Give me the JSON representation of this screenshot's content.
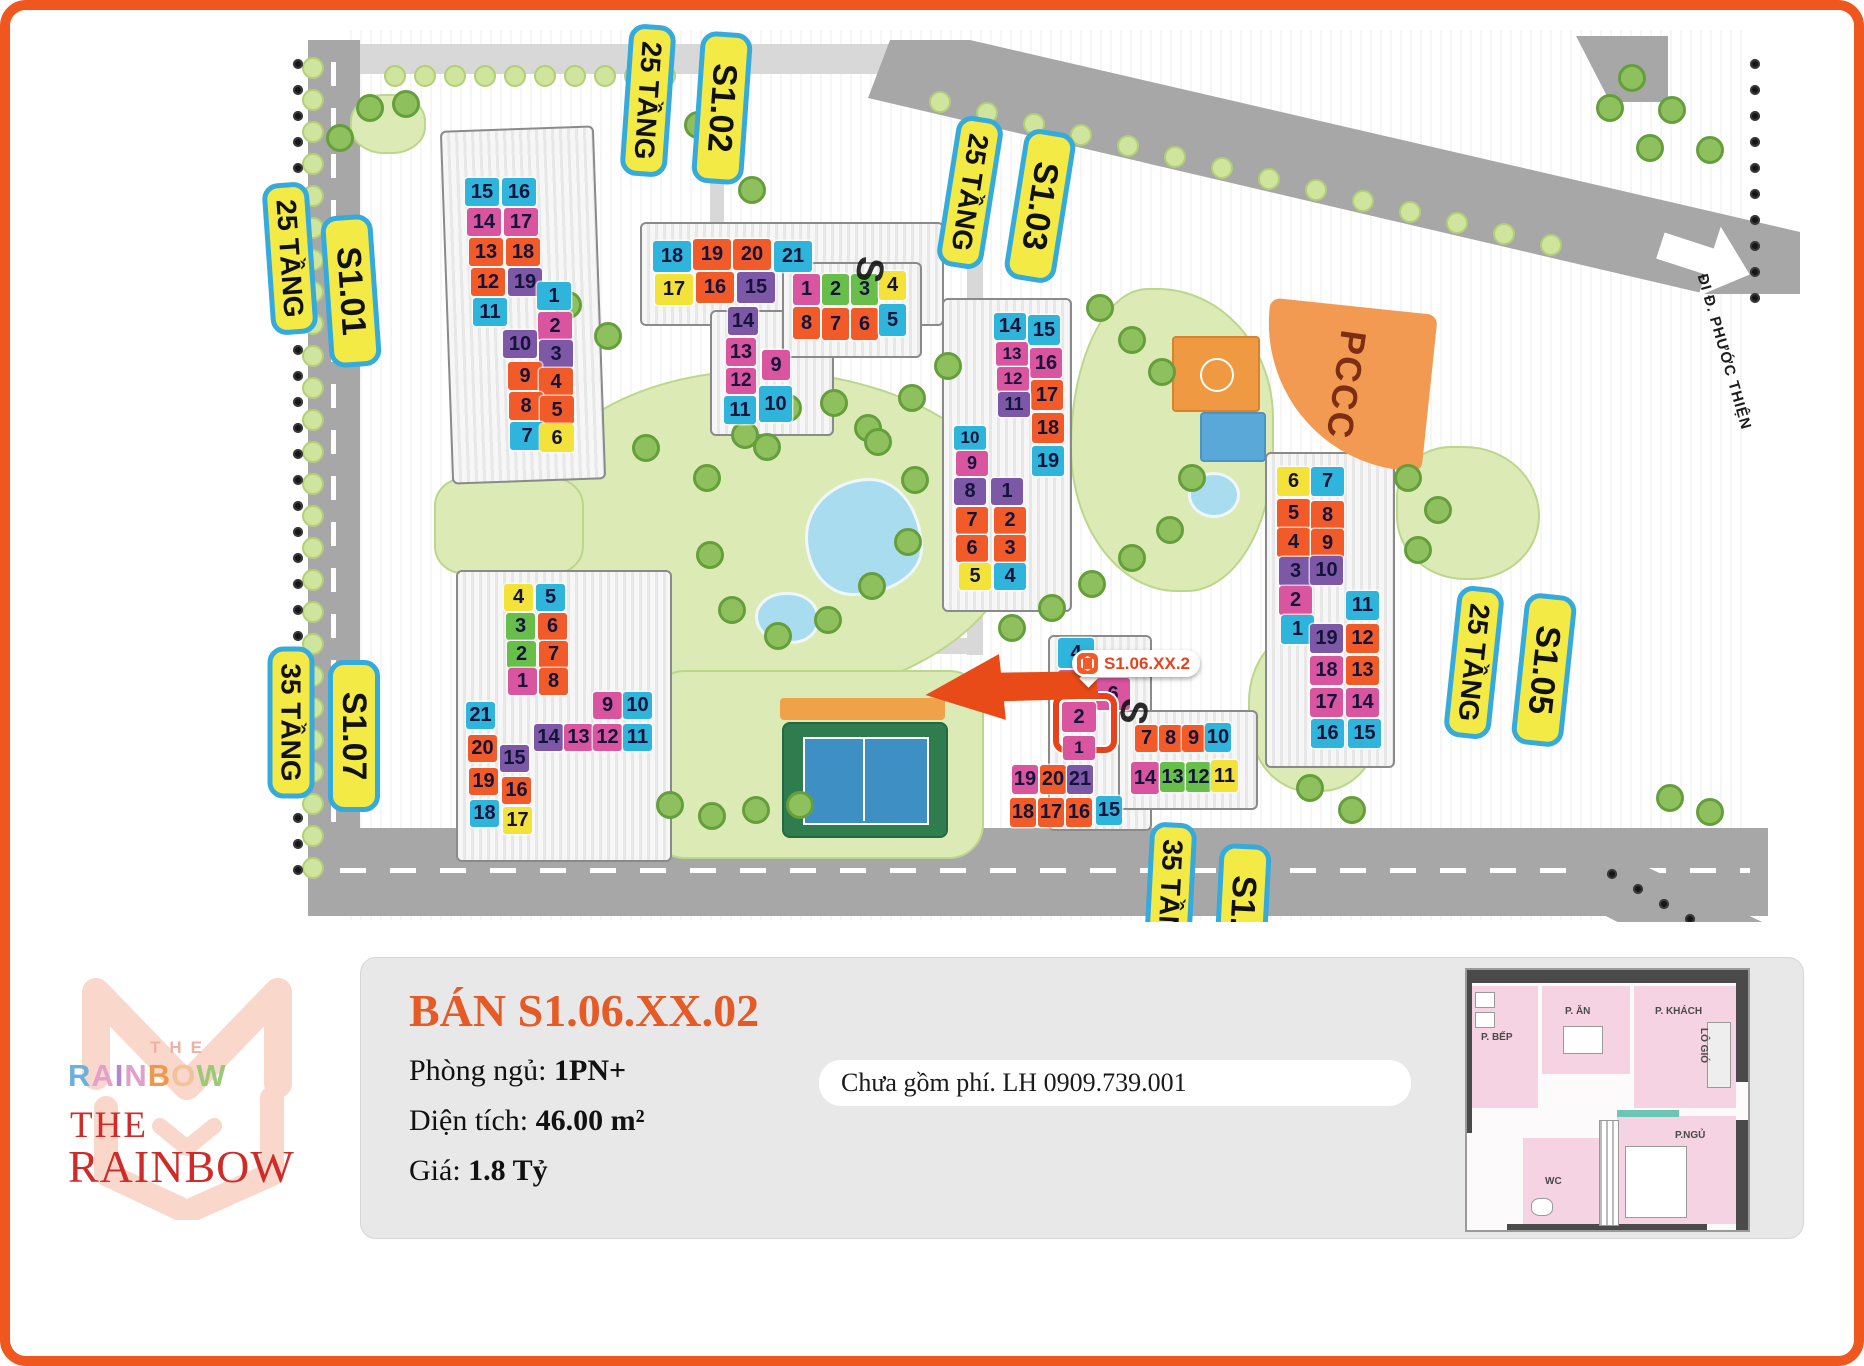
{
  "map": {
    "street_name": "ĐI Đ. PHƯỚC THIỆN",
    "pccc_label": "PCCC",
    "marker_text": "S1.06.XX.2",
    "palette": {
      "cyan": "#2fb4dc",
      "magenta": "#d9559f",
      "orange": "#f15a29",
      "purple": "#7d58a6",
      "yellow": "#f3e239",
      "green": "#67bf4a",
      "highlight": "#e8421c",
      "pill_bg": "#f4ea45",
      "pill_border": "#35aadc"
    },
    "pills": [
      {
        "text": "25 TẦNG",
        "x": 256,
        "y": 172,
        "rot": 86,
        "kind": "floors"
      },
      {
        "text": "S1.01",
        "x": 315,
        "y": 205,
        "rot": 86,
        "kind": "tower"
      },
      {
        "text": "25 TẦNG",
        "x": 614,
        "y": 14,
        "rot": 94,
        "kind": "floors"
      },
      {
        "text": "S1.02",
        "x": 686,
        "y": 22,
        "rot": 94,
        "kind": "tower"
      },
      {
        "text": "25 TẦNG",
        "x": 936,
        "y": 106,
        "rot": 99,
        "kind": "floors"
      },
      {
        "text": "S1.03",
        "x": 1004,
        "y": 120,
        "rot": 99,
        "kind": "tower"
      },
      {
        "text": "25 TẦNG",
        "x": 1440,
        "y": 576,
        "rot": 96,
        "kind": "floors"
      },
      {
        "text": "S1.05",
        "x": 1508,
        "y": 584,
        "rot": 96,
        "kind": "tower"
      },
      {
        "text": "35 TẦNG",
        "x": 257,
        "y": 636,
        "rot": 90,
        "kind": "floors"
      },
      {
        "text": "S1.07",
        "x": 318,
        "y": 650,
        "rot": 90,
        "kind": "tower"
      },
      {
        "text": "35 TẦNG",
        "x": 1136,
        "y": 812,
        "rot": 93,
        "kind": "floors"
      },
      {
        "text": "S1.06",
        "x": 1206,
        "y": 834,
        "rot": 93,
        "kind": "tower"
      }
    ],
    "decor_letters": [
      {
        "t": "S",
        "x": 846,
        "y": 238,
        "rot": 100
      },
      {
        "t": "S",
        "x": 1110,
        "y": 680,
        "rot": 100
      }
    ],
    "buildings": [
      {
        "id": "s1-01",
        "tw": 34,
        "th": 28,
        "tiles": [
          {
            "n": "15",
            "c": "cy",
            "x": 455,
            "y": 168
          },
          {
            "n": "16",
            "c": "cy",
            "x": 492,
            "y": 168
          },
          {
            "n": "14",
            "c": "mg",
            "x": 457,
            "y": 198
          },
          {
            "n": "17",
            "c": "mg",
            "x": 494,
            "y": 198
          },
          {
            "n": "13",
            "c": "or",
            "x": 459,
            "y": 228
          },
          {
            "n": "18",
            "c": "or",
            "x": 496,
            "y": 228
          },
          {
            "n": "12",
            "c": "or",
            "x": 461,
            "y": 258
          },
          {
            "n": "19",
            "c": "pu",
            "x": 498,
            "y": 258
          },
          {
            "n": "11",
            "c": "cy",
            "x": 463,
            "y": 288
          },
          {
            "n": "1",
            "c": "cy",
            "x": 527,
            "y": 272
          },
          {
            "n": "2",
            "c": "mg",
            "x": 528,
            "y": 302
          },
          {
            "n": "10",
            "c": "pu",
            "x": 493,
            "y": 320
          },
          {
            "n": "3",
            "c": "pu",
            "x": 529,
            "y": 330
          },
          {
            "n": "9",
            "c": "or",
            "x": 498,
            "y": 352
          },
          {
            "n": "4",
            "c": "or",
            "x": 529,
            "y": 358
          },
          {
            "n": "8",
            "c": "or",
            "x": 499,
            "y": 382
          },
          {
            "n": "5",
            "c": "or",
            "x": 530,
            "y": 386
          },
          {
            "n": "7",
            "c": "cy",
            "x": 500,
            "y": 412
          },
          {
            "n": "6",
            "c": "ye",
            "x": 530,
            "y": 414
          }
        ]
      },
      {
        "id": "s1-02",
        "tw": 38,
        "th": 31,
        "tiles": [
          {
            "n": "18",
            "c": "cy",
            "x": 643,
            "y": 231
          },
          {
            "n": "19",
            "c": "or",
            "x": 683,
            "y": 229
          },
          {
            "n": "20",
            "c": "or",
            "x": 723,
            "y": 229
          },
          {
            "n": "21",
            "c": "cy",
            "x": 764,
            "y": 231
          },
          {
            "n": "17",
            "c": "ye",
            "x": 645,
            "y": 264
          },
          {
            "n": "16",
            "c": "or",
            "x": 686,
            "y": 262
          },
          {
            "n": "15",
            "c": "pu",
            "x": 727,
            "y": 262
          },
          {
            "n": "14",
            "c": "pu",
            "x": 718,
            "y": 297,
            "w": 30,
            "h": 28
          },
          {
            "n": "13",
            "c": "mg",
            "x": 716,
            "y": 328,
            "w": 30,
            "h": 28
          },
          {
            "n": "9",
            "c": "mg",
            "x": 752,
            "y": 340,
            "w": 28,
            "h": 30
          },
          {
            "n": "12",
            "c": "mg",
            "x": 716,
            "y": 358,
            "w": 30,
            "h": 26
          },
          {
            "n": "11",
            "c": "cy",
            "x": 714,
            "y": 386,
            "w": 32,
            "h": 28
          },
          {
            "n": "10",
            "c": "cy",
            "x": 749,
            "y": 376,
            "w": 33,
            "h": 36
          },
          {
            "n": "1",
            "c": "mg",
            "x": 783,
            "y": 264,
            "w": 27,
            "h": 31
          },
          {
            "n": "2",
            "c": "gr",
            "x": 812,
            "y": 264,
            "w": 27,
            "h": 31
          },
          {
            "n": "3",
            "c": "gr",
            "x": 841,
            "y": 264,
            "w": 27,
            "h": 31
          },
          {
            "n": "4",
            "c": "ye",
            "x": 869,
            "y": 261,
            "w": 27,
            "h": 29
          },
          {
            "n": "8",
            "c": "or",
            "x": 783,
            "y": 297,
            "w": 27,
            "h": 32
          },
          {
            "n": "7",
            "c": "or",
            "x": 812,
            "y": 298,
            "w": 27,
            "h": 32
          },
          {
            "n": "6",
            "c": "or",
            "x": 841,
            "y": 298,
            "w": 27,
            "h": 32
          },
          {
            "n": "5",
            "c": "cy",
            "x": 869,
            "y": 294,
            "w": 27,
            "h": 32
          }
        ]
      },
      {
        "id": "s1-03",
        "tw": 32,
        "th": 27,
        "tiles": [
          {
            "n": "14",
            "c": "cy",
            "x": 984,
            "y": 303
          },
          {
            "n": "15",
            "c": "cy",
            "x": 1018,
            "y": 305,
            "h": 30
          },
          {
            "n": "13",
            "c": "mg",
            "x": 986,
            "y": 332,
            "h": 24
          },
          {
            "n": "16",
            "c": "mg",
            "x": 1020,
            "y": 338,
            "h": 30
          },
          {
            "n": "12",
            "c": "mg",
            "x": 987,
            "y": 357,
            "h": 24
          },
          {
            "n": "17",
            "c": "or",
            "x": 1021,
            "y": 370,
            "h": 30
          },
          {
            "n": "11",
            "c": "pu",
            "x": 988,
            "y": 382,
            "h": 25
          },
          {
            "n": "18",
            "c": "or",
            "x": 1022,
            "y": 403,
            "h": 30
          },
          {
            "n": "19",
            "c": "cy",
            "x": 1022,
            "y": 436,
            "h": 30
          },
          {
            "n": "10",
            "c": "cy",
            "x": 944,
            "y": 416,
            "h": 24
          },
          {
            "n": "9",
            "c": "mg",
            "x": 946,
            "y": 441,
            "h": 25
          },
          {
            "n": "8",
            "c": "pu",
            "x": 944,
            "y": 468
          },
          {
            "n": "1",
            "c": "pu",
            "x": 981,
            "y": 468
          },
          {
            "n": "7",
            "c": "or",
            "x": 946,
            "y": 497
          },
          {
            "n": "2",
            "c": "or",
            "x": 984,
            "y": 497
          },
          {
            "n": "6",
            "c": "or",
            "x": 946,
            "y": 525
          },
          {
            "n": "3",
            "c": "or",
            "x": 984,
            "y": 525
          },
          {
            "n": "5",
            "c": "ye",
            "x": 949,
            "y": 553
          },
          {
            "n": "4",
            "c": "cy",
            "x": 984,
            "y": 553
          }
        ]
      },
      {
        "id": "s1-05",
        "tw": 33,
        "th": 29,
        "tiles": [
          {
            "n": "6",
            "c": "ye",
            "x": 1267,
            "y": 457
          },
          {
            "n": "7",
            "c": "cy",
            "x": 1301,
            "y": 457
          },
          {
            "n": "5",
            "c": "or",
            "x": 1267,
            "y": 489
          },
          {
            "n": "8",
            "c": "or",
            "x": 1301,
            "y": 491
          },
          {
            "n": "4",
            "c": "or",
            "x": 1267,
            "y": 518
          },
          {
            "n": "9",
            "c": "or",
            "x": 1301,
            "y": 519
          },
          {
            "n": "3",
            "c": "pu",
            "x": 1269,
            "y": 547
          },
          {
            "n": "10",
            "c": "pu",
            "x": 1300,
            "y": 546
          },
          {
            "n": "2",
            "c": "mg",
            "x": 1269,
            "y": 576
          },
          {
            "n": "11",
            "c": "cy",
            "x": 1336,
            "y": 581
          },
          {
            "n": "1",
            "c": "cy",
            "x": 1271,
            "y": 605
          },
          {
            "n": "19",
            "c": "pu",
            "x": 1300,
            "y": 614
          },
          {
            "n": "12",
            "c": "or",
            "x": 1336,
            "y": 614
          },
          {
            "n": "18",
            "c": "mg",
            "x": 1300,
            "y": 646
          },
          {
            "n": "13",
            "c": "or",
            "x": 1336,
            "y": 646
          },
          {
            "n": "17",
            "c": "mg",
            "x": 1300,
            "y": 678
          },
          {
            "n": "14",
            "c": "mg",
            "x": 1336,
            "y": 678
          },
          {
            "n": "16",
            "c": "cy",
            "x": 1301,
            "y": 709
          },
          {
            "n": "15",
            "c": "cy",
            "x": 1338,
            "y": 709
          }
        ]
      },
      {
        "id": "s1-07",
        "tw": 29,
        "th": 27,
        "tiles": [
          {
            "n": "4",
            "c": "ye",
            "x": 494,
            "y": 574
          },
          {
            "n": "5",
            "c": "cy",
            "x": 526,
            "y": 574
          },
          {
            "n": "3",
            "c": "gr",
            "x": 496,
            "y": 603
          },
          {
            "n": "6",
            "c": "or",
            "x": 528,
            "y": 603
          },
          {
            "n": "2",
            "c": "gr",
            "x": 497,
            "y": 631
          },
          {
            "n": "7",
            "c": "or",
            "x": 529,
            "y": 631
          },
          {
            "n": "1",
            "c": "mg",
            "x": 498,
            "y": 658
          },
          {
            "n": "8",
            "c": "or",
            "x": 529,
            "y": 658
          },
          {
            "n": "9",
            "c": "mg",
            "x": 583,
            "y": 682
          },
          {
            "n": "10",
            "c": "cy",
            "x": 613,
            "y": 682
          },
          {
            "n": "14",
            "c": "pu",
            "x": 524,
            "y": 714
          },
          {
            "n": "13",
            "c": "mg",
            "x": 554,
            "y": 714
          },
          {
            "n": "12",
            "c": "mg",
            "x": 583,
            "y": 714
          },
          {
            "n": "11",
            "c": "cy",
            "x": 613,
            "y": 714
          },
          {
            "n": "21",
            "c": "cy",
            "x": 456,
            "y": 692
          },
          {
            "n": "20",
            "c": "or",
            "x": 458,
            "y": 725
          },
          {
            "n": "19",
            "c": "or",
            "x": 459,
            "y": 758
          },
          {
            "n": "18",
            "c": "cy",
            "x": 460,
            "y": 790
          },
          {
            "n": "15",
            "c": "pu",
            "x": 490,
            "y": 735
          },
          {
            "n": "16",
            "c": "or",
            "x": 492,
            "y": 767
          },
          {
            "n": "17",
            "c": "ye",
            "x": 493,
            "y": 797
          }
        ]
      },
      {
        "id": "s1-06",
        "tw": 26,
        "th": 29,
        "tiles": [
          {
            "n": "4",
            "c": "cy",
            "x": 1048,
            "y": 628,
            "w": 36,
            "h": 30
          },
          {
            "n": "3",
            "c": "mg",
            "x": 1048,
            "y": 660,
            "w": 36,
            "h": 30
          },
          {
            "n": "6",
            "c": "mg",
            "x": 1086,
            "y": 668,
            "w": 34,
            "h": 32
          },
          {
            "n": "2",
            "c": "mg",
            "x": 1052,
            "y": 692,
            "w": 34,
            "h": 30,
            "hl": true
          },
          {
            "n": "1",
            "c": "mg",
            "x": 1053,
            "y": 726,
            "w": 32,
            "h": 24
          },
          {
            "n": "19",
            "c": "mg",
            "x": 1002,
            "y": 755
          },
          {
            "n": "20",
            "c": "or",
            "x": 1030,
            "y": 755
          },
          {
            "n": "21",
            "c": "pu",
            "x": 1057,
            "y": 755
          },
          {
            "n": "18",
            "c": "or",
            "x": 1000,
            "y": 788
          },
          {
            "n": "17",
            "c": "or",
            "x": 1028,
            "y": 788
          },
          {
            "n": "16",
            "c": "or",
            "x": 1056,
            "y": 788
          },
          {
            "n": "15",
            "c": "cy",
            "x": 1086,
            "y": 786
          },
          {
            "n": "7",
            "c": "or",
            "x": 1125,
            "y": 715,
            "w": 23,
            "h": 27
          },
          {
            "n": "8",
            "c": "or",
            "x": 1149,
            "y": 715,
            "w": 23,
            "h": 27
          },
          {
            "n": "9",
            "c": "or",
            "x": 1172,
            "y": 715,
            "w": 23,
            "h": 27
          },
          {
            "n": "10",
            "c": "cy",
            "x": 1195,
            "y": 713,
            "w": 26,
            "h": 29
          },
          {
            "n": "14",
            "c": "mg",
            "x": 1121,
            "y": 752,
            "w": 28,
            "h": 32
          },
          {
            "n": "13",
            "c": "gr",
            "x": 1150,
            "y": 752,
            "w": 25,
            "h": 30
          },
          {
            "n": "12",
            "c": "gr",
            "x": 1176,
            "y": 752,
            "w": 25,
            "h": 30
          },
          {
            "n": "11",
            "c": "ye",
            "x": 1201,
            "y": 750,
            "w": 27,
            "h": 32
          }
        ]
      }
    ]
  },
  "panel": {
    "title": "BÁN S1.06.XX.02",
    "details": [
      {
        "label": "Phòng ngủ: ",
        "value": "1PN+"
      },
      {
        "label": "Diện tích: ",
        "value": "46.00 m²"
      },
      {
        "label": "Giá: ",
        "value": "1.8 Tỷ"
      }
    ],
    "contact": "Chưa gồm phí. LH 0909.739.001",
    "logo": {
      "the_small": "THE",
      "rainbow_colored": "RAINBOW",
      "letter_colors": [
        "#6db0dc",
        "#e49fcc",
        "#b089cc",
        "#dfa0cb",
        "#eb9a4d",
        "#f2c29a",
        "#9cc978"
      ],
      "the_red": "THE",
      "rainbow_red": "RAINBOW"
    },
    "floorplan": {
      "kitchen": "P. BẾP",
      "dining": "P. ĂN",
      "living": "P. KHÁCH",
      "loggia": "LÔ GIÓ",
      "bedroom": "P.NGỦ",
      "wc": "WC"
    }
  }
}
